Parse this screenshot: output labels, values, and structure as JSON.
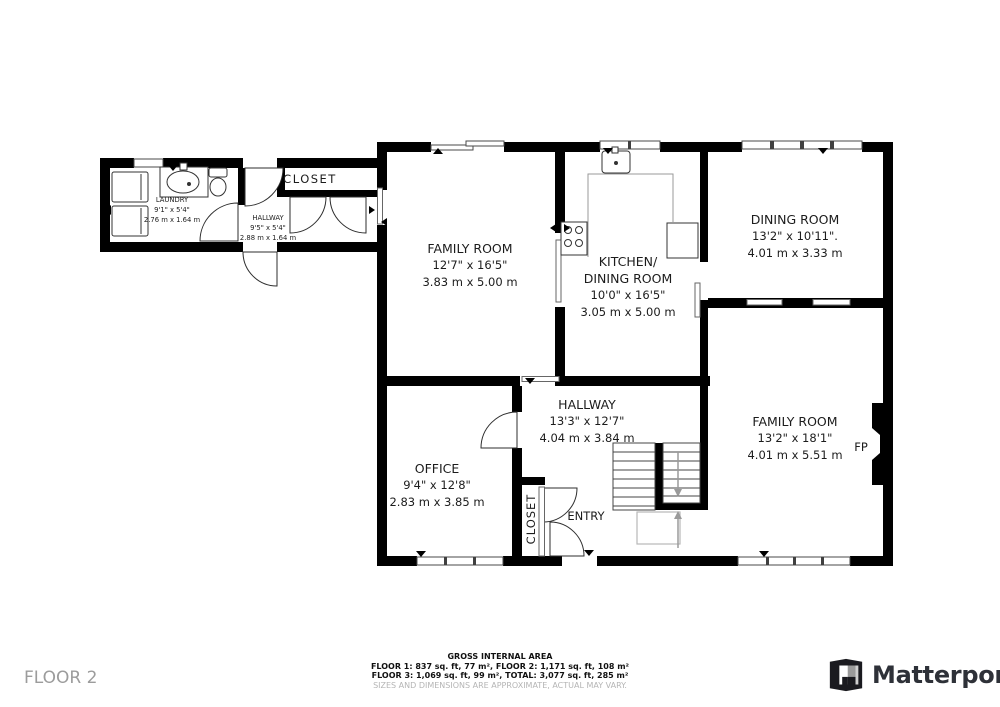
{
  "floor_label": "FLOOR 2",
  "rooms": {
    "laundry": {
      "name": "LAUNDRY",
      "ft": "9'1\" x 5'4\"",
      "m": "2.76 m x 1.64 m"
    },
    "hallway_wing": {
      "name": "HALLWAY",
      "ft": "9'5\" x 5'4\"",
      "m": "2.88 m x 1.64 m"
    },
    "closet_wing": {
      "name": "CLOSET"
    },
    "family_left": {
      "name": "FAMILY ROOM",
      "ft": "12'7\" x 16'5\"",
      "m": "3.83 m x 5.00 m"
    },
    "kitchen": {
      "name_line1": "KITCHEN/",
      "name_line2": "DINING ROOM",
      "ft": "10'0\" x 16'5\"",
      "m": "3.05 m x 5.00 m"
    },
    "dining": {
      "name": "DINING ROOM",
      "ft": "13'2\" x 10'11\".",
      "m": "4.01 m x 3.33 m"
    },
    "hallway_main": {
      "name": "HALLWAY",
      "ft": "13'3\" x 12'7\"",
      "m": "4.04 m x 3.84 m"
    },
    "office": {
      "name": "OFFICE",
      "ft": "9'4\" x 12'8\"",
      "m": "2.83 m x 3.85 m"
    },
    "family_right": {
      "name": "FAMILY ROOM",
      "ft": "13'2\" x 18'1\"",
      "m": "4.01 m x 5.51 m"
    },
    "entry": {
      "name": "ENTRY"
    },
    "closet_entry": {
      "name": "CLOSET"
    },
    "fireplace": {
      "name": "FP"
    }
  },
  "footer": {
    "title": "GROSS INTERNAL AREA",
    "line1": "FLOOR 1: 837 sq. ft, 77 m², FLOOR 2: 1,171 sq. ft, 108 m²",
    "line2": "FLOOR 3: 1,069 sq. ft, 99 m², TOTAL: 3,077 sq. ft, 285 m²",
    "disclaimer": "SIZES AND DIMENSIONS ARE APPROXIMATE, ACTUAL MAY VARY."
  },
  "brand": {
    "name": "Matterport"
  },
  "colors": {
    "wall": "#000000",
    "label_text": "#1c1c1c",
    "muted_text": "#9c9c9c",
    "disclaimer_text": "#b5b5b5"
  }
}
